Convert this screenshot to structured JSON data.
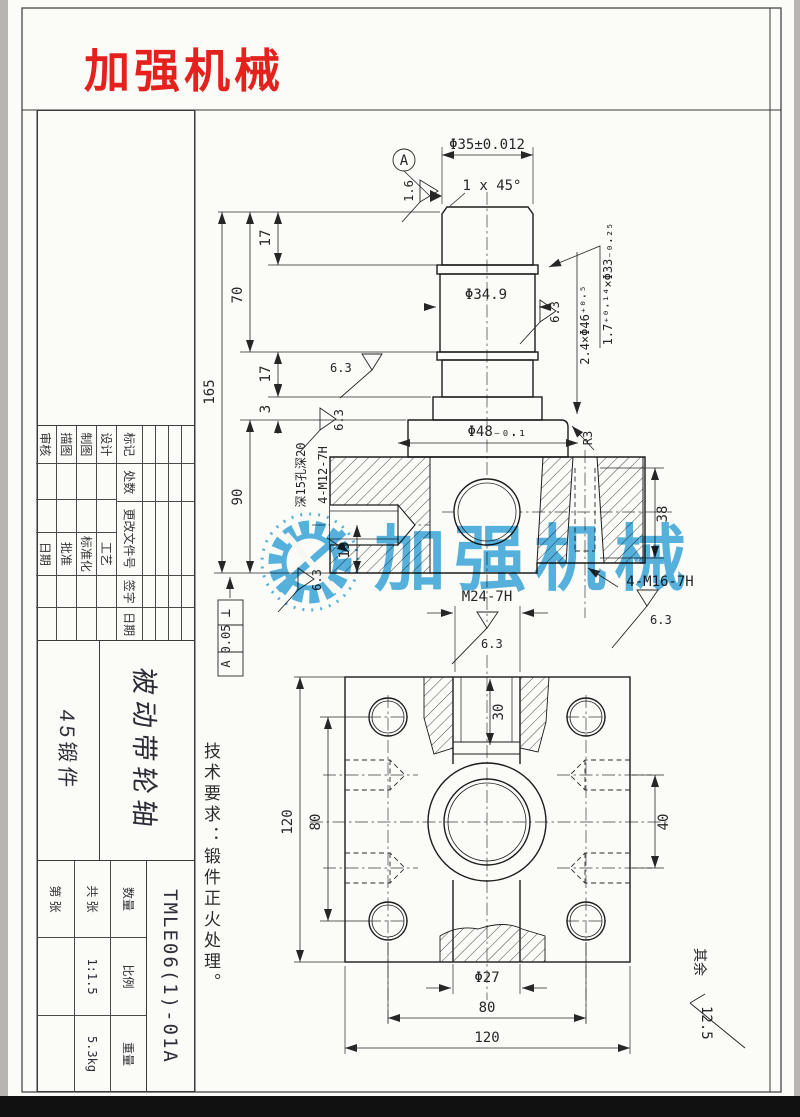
{
  "page": {
    "brand": "加强机械",
    "watermark": "加强机械",
    "colors": {
      "brand_red": "#e4211c",
      "watermark_blue": "#2ba0dc",
      "paper": "#fbfbf8",
      "line": "#262626"
    }
  },
  "front_view": {
    "top_dia": "Φ35±0.012",
    "chamfer": "1 x 45°",
    "datum_label": "A",
    "datum_roughness": "1.6",
    "mid_dia": "Φ34.9",
    "groove": "1.7⁺⁰·¹⁴×Φ33₋₀.₂₅",
    "relief": "2.4×Φ46⁺⁰·⁵",
    "flange_dia": "Φ48₋₀.₁",
    "fillet": "R3",
    "side_thread": "4-M12-7H",
    "side_thread_note": "深15孔深20",
    "bottom_thread": "4-M16-7H",
    "center_thread": "M24-7H",
    "roughness": "6.3",
    "len_total": "165",
    "len_upper": "70",
    "len_17": "17",
    "len_3": "3",
    "len_body": "90",
    "len_19": "19",
    "len_38": "38",
    "tol_frame": {
      "sym": "⊥",
      "val": "0.05",
      "datum": "A"
    }
  },
  "bottom_view": {
    "size_120": "120",
    "pitch_80": "80",
    "pitch_40": "40",
    "depth_30": "30",
    "hole_dia": "Φ27",
    "pitch_80b": "80",
    "size_120b": "120"
  },
  "notes": {
    "tech_req": "技术要求：锻件正火处理。",
    "rest_label": "其余",
    "rest_value": "12.5"
  },
  "title_block": {
    "rev_headers": [
      "标记",
      "处数",
      "更改文件号",
      "签字",
      "日期"
    ],
    "rows": [
      {
        "l": "设计",
        "r": "工艺"
      },
      {
        "l": "制图",
        "r": "标准化"
      },
      {
        "l": "描图",
        "r": "批准"
      },
      {
        "l": "审核",
        "r": "日期"
      }
    ],
    "part_name": "被动带轮轴",
    "material": "45锻件",
    "drawing_no": "TMLE06(1)-01A",
    "qty_label": "数量",
    "scale_label": "比例",
    "scale_value": "1:1.5",
    "weight_label": "重量",
    "weight_value": "5.3kg",
    "sheets_total": "共 张",
    "sheet_no": "第 张"
  }
}
